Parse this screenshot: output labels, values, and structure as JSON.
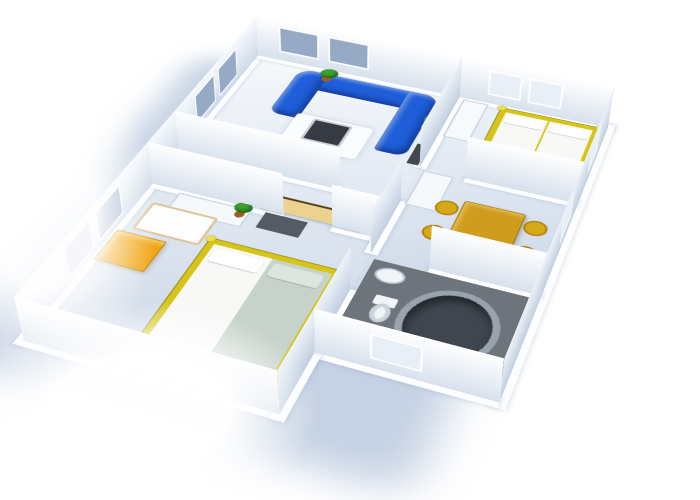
{
  "scene": {
    "kind": "3D rendered apartment floor plan viewed from above at an angle, plan rotated about 21 degrees",
    "background": "#ffffff",
    "wall_light": "#ffffff",
    "wall_shade": "#c9d5e6",
    "floor_light": "#f4f7fb",
    "floor_shade": "#bcc9dc",
    "drop_shadow": "#b6c6dd"
  },
  "palette": {
    "sofa_blue": "#1f5ed8",
    "window_pane": "#96aac6",
    "window_bright": "#e9eff7",
    "bed_frame_gold": "#d6c518",
    "bed_knob": "#ece04a",
    "mattress_white": "#f8f9f7",
    "mattress_green": "#c6d2ca",
    "pillow_white": "#ffffff",
    "pillow_shaded": "#dde5df",
    "dresser_orange": "#f1a411",
    "sideboard_tan": "#ecd18f",
    "table_gold": "#cf9c1e",
    "stool_yellow": "#d8a916",
    "fridge_white": "#f6f9fc",
    "wardrobe_white": "#f6f9fc",
    "closet_white": "#f7fafd",
    "crib_white": "#fdfdfd",
    "rug_white": "#fbfcfe",
    "rug_gold": "#e3b70d",
    "coffee_table_dark": "#363b43",
    "tv_dark": "#43484f",
    "dresser_dark": "#555b63",
    "bathroom_floor": "#6e747c",
    "tub_dark": "#3f464f",
    "tub_rim": "#99a3ae",
    "fixture_white": "#f2f5f8",
    "plant_green": "#3f9e2f",
    "plant_pot": "#a05c22"
  },
  "rooms": [
    {
      "id": "living-room",
      "furniture": [
        "blue corner sofa (U-shape)",
        "dark coffee table on white rug",
        "tv on partition wall",
        "2 potted plants"
      ]
    },
    {
      "id": "hallway",
      "furniture": [
        "tan sideboard",
        "potted plant"
      ]
    },
    {
      "id": "bedroom-1",
      "furniture": [
        "gold-frame double bed (white + green mattresses)",
        "white wardrobe",
        "dark dresser",
        "crib",
        "orange chest",
        "gold rug"
      ]
    },
    {
      "id": "bedroom-2",
      "furniture": [
        "gold-frame double bed (two white mattresses)",
        "white closet"
      ]
    },
    {
      "id": "kitchen",
      "furniture": [
        "gold dining table",
        "4 yellow stools",
        "white fridge"
      ]
    },
    {
      "id": "bathroom",
      "furniture": [
        "oval bathtub",
        "toilet",
        "pedestal sink",
        "dark tiled floor"
      ]
    }
  ]
}
